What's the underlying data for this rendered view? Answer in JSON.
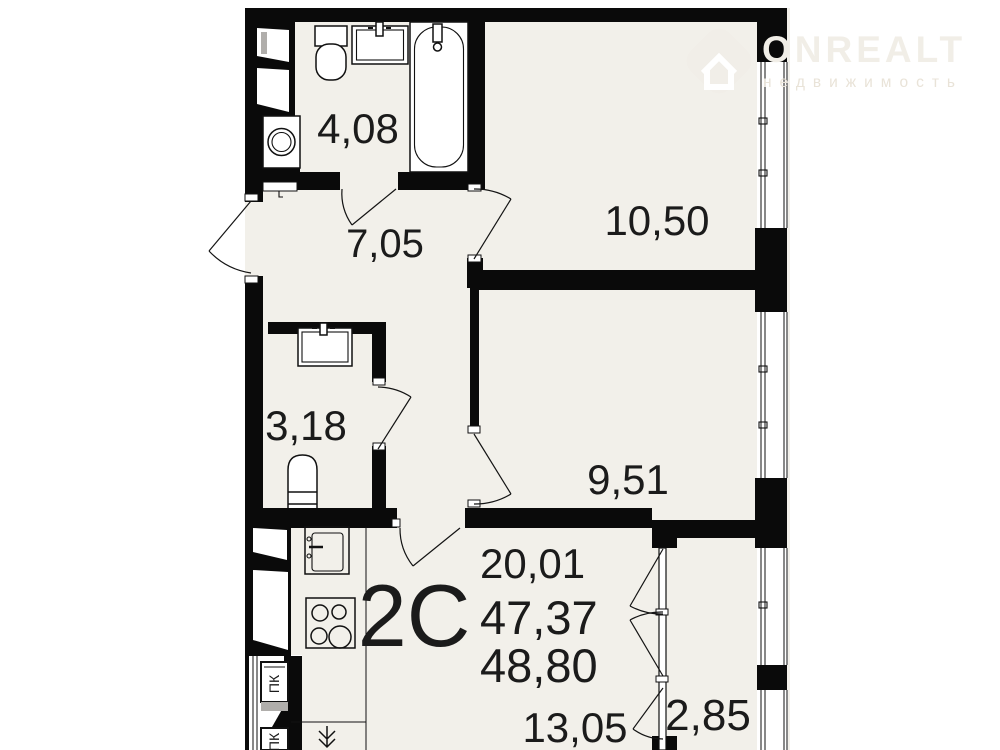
{
  "watermark": {
    "brand": "ONREALT",
    "tagline": "недвижимость"
  },
  "apartment": {
    "type_code": "2С",
    "area_line1": "20,01",
    "area_line2": "47,37",
    "area_line3": "48,80"
  },
  "rooms": {
    "bathroom": "4,08",
    "hallway": "7,05",
    "room_top": "10,50",
    "wc": "3,18",
    "room_mid": "9,51",
    "kitchen_living": "13,05",
    "balcony": "2,85"
  },
  "marks": {
    "pk_top": "ПК",
    "pk_bottom": "ПК"
  },
  "colors": {
    "floor": "#f2f0ea",
    "wall": "#0a0a0a",
    "watermark": "#f1eee7"
  }
}
